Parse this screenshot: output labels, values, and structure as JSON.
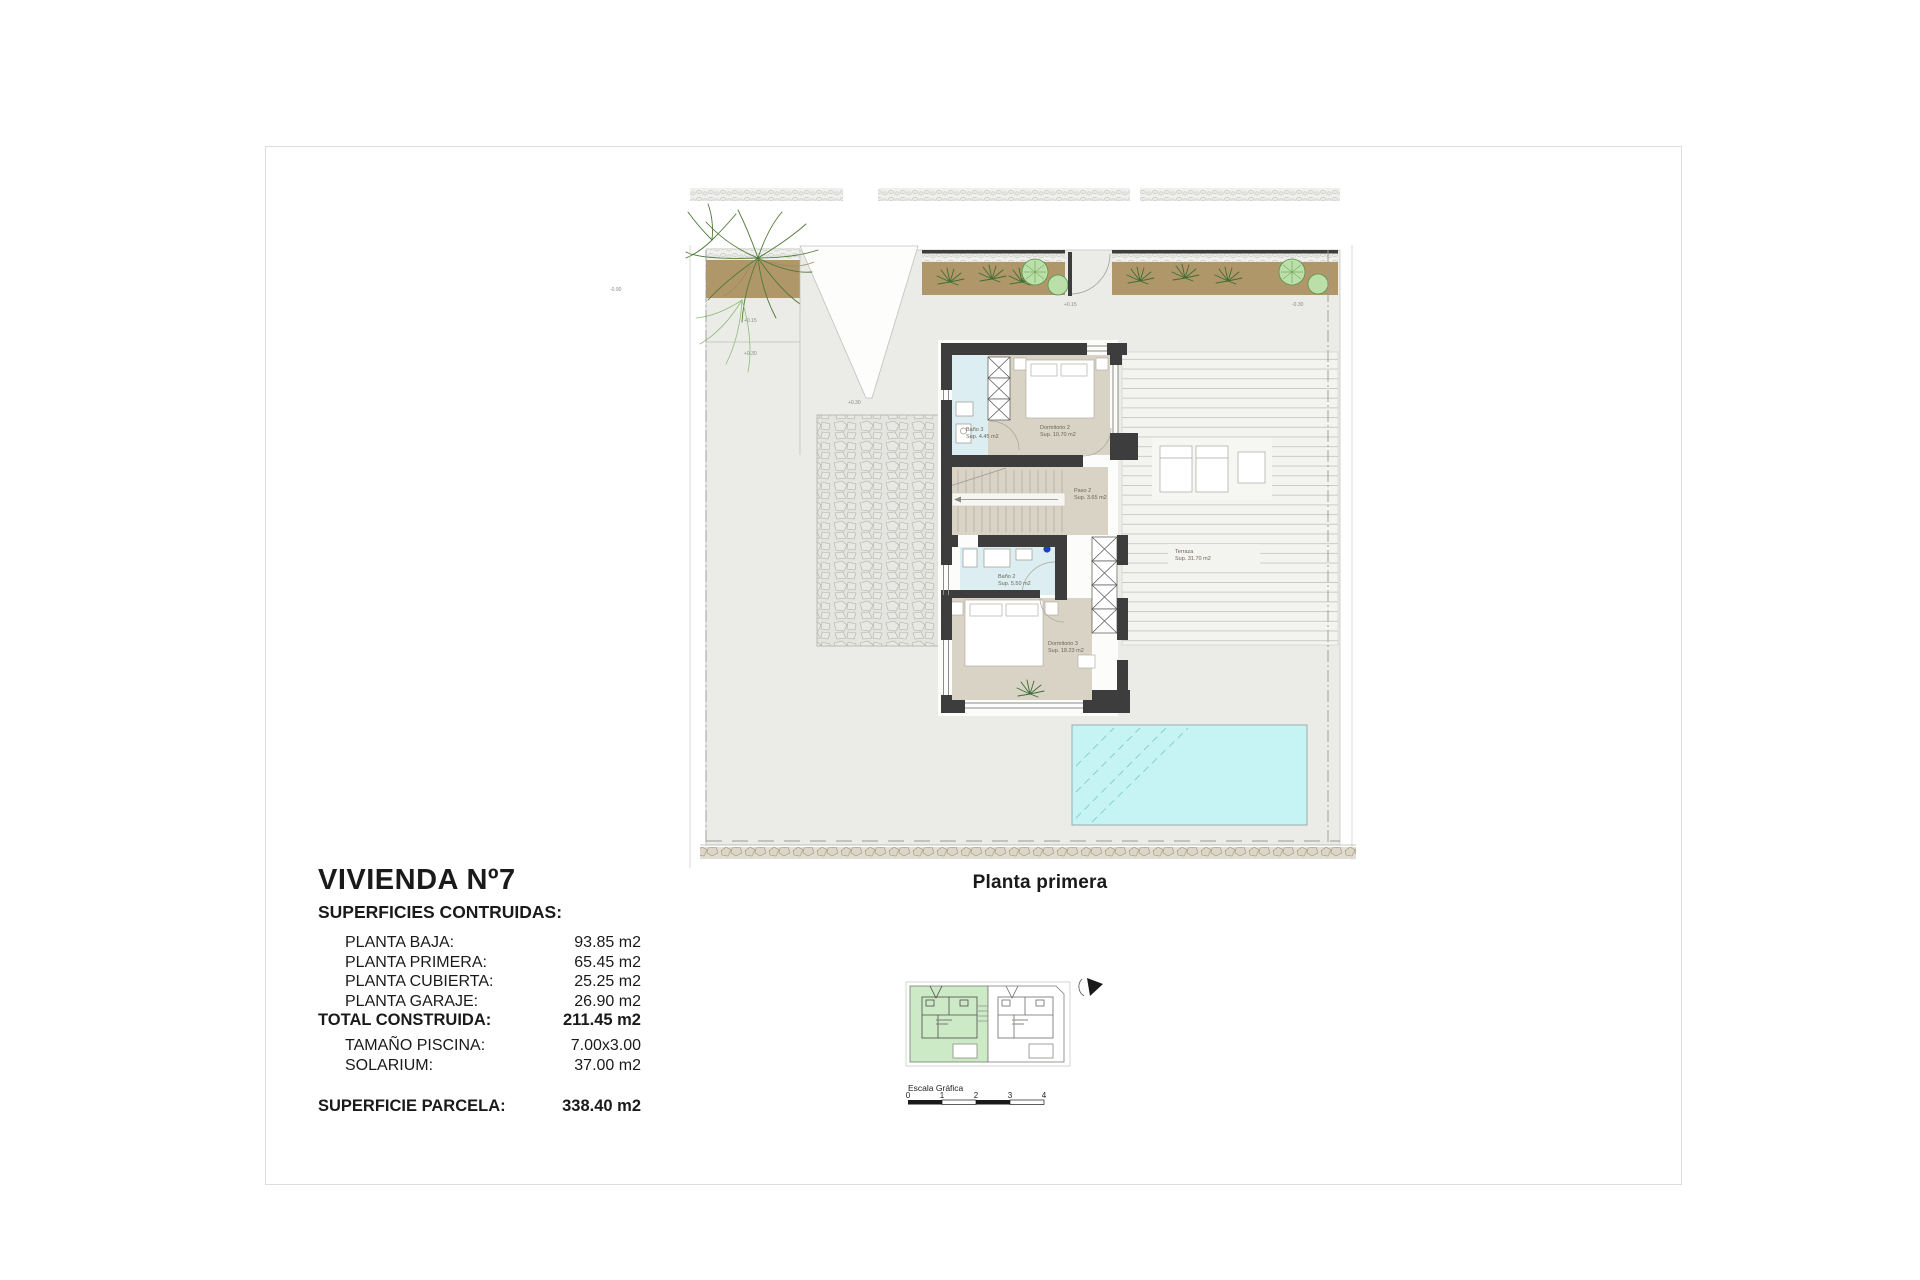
{
  "summary": {
    "title": "VIVIENDA Nº7",
    "subtitle": "SUPERFICIES CONTRUIDAS:",
    "rows": [
      {
        "label": "PLANTA BAJA:",
        "value": "93.85 m2"
      },
      {
        "label": "PLANTA PRIMERA:",
        "value": "65.45 m2"
      },
      {
        "label": "PLANTA CUBIERTA:",
        "value": "25.25 m2"
      },
      {
        "label": "PLANTA GARAJE:",
        "value": "26.90 m2"
      }
    ],
    "total": {
      "label": "TOTAL CONSTRUIDA:",
      "value": "211.45 m2"
    },
    "secondary_rows": [
      {
        "label": "TAMAÑO PISCINA:",
        "value": "7.00x3.00"
      },
      {
        "label": "SOLARIUM:",
        "value": "37.00 m2"
      }
    ],
    "parcel": {
      "label": "SUPERFICIE PARCELA:",
      "value": "338.40 m2"
    }
  },
  "plan": {
    "caption": "Planta primera",
    "rooms": [
      {
        "name": "Baño 3",
        "area": "Sup. 4.45 m2"
      },
      {
        "name": "Dormitorio 2",
        "area": "Sup. 10.70 m2"
      },
      {
        "name": "Paso 2",
        "area": "Sup. 3.65 m2"
      },
      {
        "name": "Baño 2",
        "area": "Sup. 5.50 m2"
      },
      {
        "name": "Dormitorio 3",
        "area": "Sup. 18.23 m2"
      },
      {
        "name": "Terraza",
        "area": "Sup. 31.70 m2"
      }
    ],
    "levels": [
      {
        "value": "+0.15"
      },
      {
        "value": "+0.30"
      },
      {
        "value": "+0.30"
      },
      {
        "value": "+0.15"
      },
      {
        "value": "-0.30"
      },
      {
        "value": "-0.90"
      }
    ],
    "colors": {
      "wall": "#3d3d3d",
      "bedroom_floor": "#d8d3c5",
      "bath_floor": "#dceef1",
      "pool": "#c6f3f4",
      "planting": "#b09769",
      "plot": "#ebebe8"
    }
  },
  "key_plan": {
    "scale_label": "Escala Gráfica",
    "scale_ticks": [
      "0",
      "1",
      "2",
      "3",
      "4"
    ]
  }
}
